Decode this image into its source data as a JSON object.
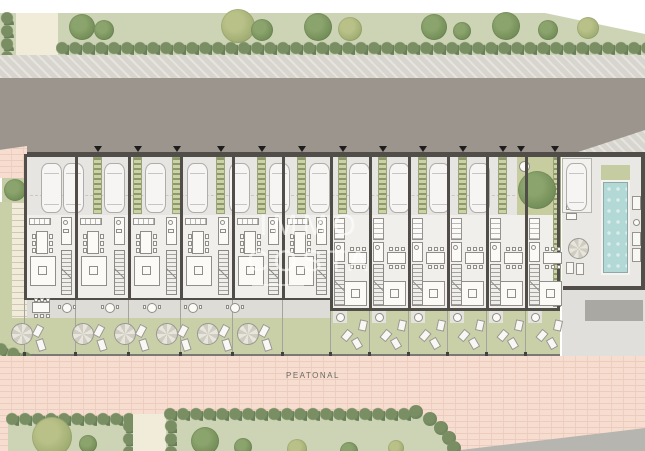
{
  "labels": {
    "pedestrian_street": "PEATONAL"
  },
  "watermark": {
    "line1": "IMMO",
    "line2": "COSTA"
  },
  "colors": {
    "green_band": "#cdd4b6",
    "hedge": "#7a8e63",
    "cream_path": "#f1ebd9",
    "sidewalk": "#d8d5ce",
    "road": "#9b958d",
    "parking": "#e6e5e1",
    "floor": "#f0efeb",
    "wall": "#514e49",
    "terrace": "#dddcd6",
    "garden": "#c9d0a7",
    "pink_path": "#f6ddcf",
    "pool_water": "#b2d9d6",
    "deck_gray": "#e0dfdb",
    "dark_gray_pad": "#a9a8a3",
    "planting_strip": "#ccd2a6",
    "courtyard": "#c7cd9f"
  },
  "site": {
    "left_units": [
      {
        "x": 24,
        "w": 51
      },
      {
        "x": 75,
        "w": 53
      },
      {
        "x": 128,
        "w": 52
      },
      {
        "x": 180,
        "w": 52
      },
      {
        "x": 232,
        "w": 50
      },
      {
        "x": 282,
        "w": 48
      }
    ],
    "right_units": [
      {
        "x": 330,
        "w": 39
      },
      {
        "x": 369,
        "w": 39
      },
      {
        "x": 408,
        "w": 39
      },
      {
        "x": 447,
        "w": 39
      },
      {
        "x": 486,
        "w": 39
      },
      {
        "x": 525,
        "w": 35
      }
    ],
    "parking_strips": [
      93,
      133,
      172,
      216,
      257,
      297,
      338,
      378,
      418,
      458,
      498
    ],
    "extra_markers": [
      517,
      551
    ],
    "cars": [
      41,
      63,
      104,
      145,
      187,
      229,
      269,
      309,
      349,
      389,
      429,
      469
    ],
    "pool_car": 566,
    "left_terrace_tables": [
      67,
      110,
      152,
      193,
      235
    ],
    "left_rect_table": {
      "x": 32,
      "y": 302
    },
    "left_parasols": [
      22,
      83,
      125,
      167,
      208,
      248
    ],
    "top_trees": [
      {
        "x": 82,
        "y": 27,
        "r": 13
      },
      {
        "x": 104,
        "y": 30,
        "r": 10
      },
      {
        "x": 238,
        "y": 26,
        "r": 17,
        "shade": "light"
      },
      {
        "x": 262,
        "y": 30,
        "r": 11
      },
      {
        "x": 318,
        "y": 27,
        "r": 14
      },
      {
        "x": 350,
        "y": 29,
        "r": 12,
        "shade": "light"
      },
      {
        "x": 434,
        "y": 27,
        "r": 13
      },
      {
        "x": 462,
        "y": 31,
        "r": 9
      },
      {
        "x": 506,
        "y": 26,
        "r": 14
      },
      {
        "x": 548,
        "y": 30,
        "r": 10
      },
      {
        "x": 588,
        "y": 28,
        "r": 11,
        "shade": "light"
      }
    ],
    "left_park_trees": [
      {
        "x": 52,
        "y": 437,
        "r": 20,
        "shade": "light"
      },
      {
        "x": 88,
        "y": 444,
        "r": 9
      }
    ],
    "mid_park_trees": [
      {
        "x": 205,
        "y": 441,
        "r": 14
      },
      {
        "x": 243,
        "y": 447,
        "r": 9
      },
      {
        "x": 297,
        "y": 449,
        "r": 10,
        "shade": "light"
      },
      {
        "x": 349,
        "y": 451,
        "r": 9
      },
      {
        "x": 396,
        "y": 448,
        "r": 8,
        "shade": "light"
      }
    ],
    "curve_hedge": [
      [
        416,
        412
      ],
      [
        430,
        419
      ],
      [
        441,
        428
      ],
      [
        449,
        438
      ],
      [
        454,
        448
      ]
    ],
    "margin_tree": {
      "x": 15,
      "y": 190,
      "r": 11
    },
    "courtyard_tree": {
      "x": 537,
      "y": 190,
      "r": 19
    }
  }
}
